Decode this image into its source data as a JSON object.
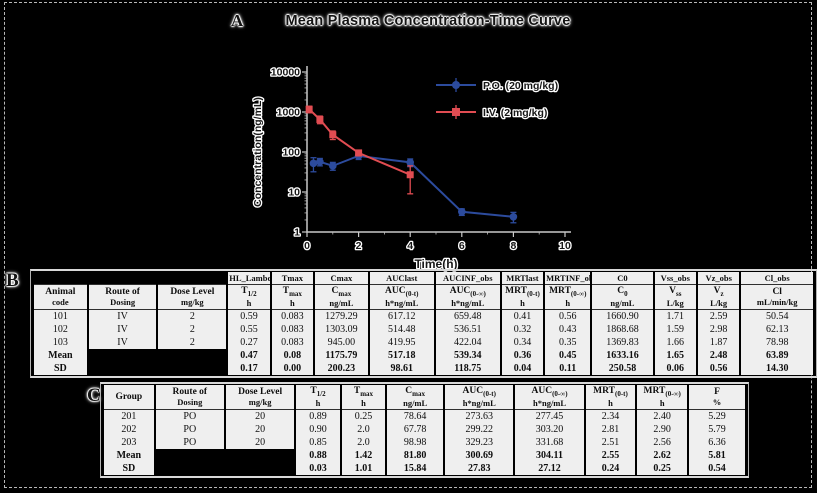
{
  "panel_a": {
    "label": "A",
    "title": "Mean Plasma Concentration-Time Curve"
  },
  "chart_data": {
    "type": "line",
    "title": "Mean Plasma Concentration-Time Curve",
    "xlabel": "Time(h)",
    "ylabel": "Concentration(ng/mL)",
    "xlim": [
      0,
      10
    ],
    "ylim": [
      1,
      10000
    ],
    "yscale": "log",
    "x_ticks": [
      0,
      2,
      4,
      6,
      8,
      10
    ],
    "y_ticks": [
      1,
      10,
      100,
      1000,
      10000
    ],
    "grid": false,
    "legend_position": "upper right",
    "series": [
      {
        "name": "P.O. (20 mg/kg)",
        "color": "#2c4b9d",
        "marker": "circle",
        "x": [
          0.25,
          0.5,
          1,
          2,
          4,
          6,
          8
        ],
        "y": [
          52,
          57,
          45,
          80,
          55,
          3.2,
          2.4
        ],
        "yerr": [
          20,
          12,
          10,
          15,
          12,
          0.6,
          0.7
        ]
      },
      {
        "name": "I.V. (2 mg/kg)",
        "color": "#e14c52",
        "marker": "square",
        "x": [
          0.083,
          0.5,
          1,
          2,
          4
        ],
        "y": [
          1175,
          650,
          270,
          95,
          27
        ],
        "yerr": [
          220,
          140,
          65,
          15,
          18
        ]
      }
    ]
  },
  "panel_b": {
    "label": "B",
    "table": {
      "code_row": [
        "",
        "",
        "",
        "HL_Lambda",
        "Tmax",
        "Cmax",
        "AUClast",
        "AUCINF_obs",
        "MRTlast",
        "MRTINF_obs",
        "C0",
        "Vss_obs",
        "Vz_obs",
        "Cl_obs"
      ],
      "headers": [
        {
          "main": "Animal",
          "line2": "code"
        },
        {
          "main": "Route of",
          "line2": "Dosing"
        },
        {
          "main": "Dose Level",
          "unit": "mg/kg"
        },
        {
          "main": "T",
          "sub": "1/2",
          "unit": "h"
        },
        {
          "main": "T",
          "sub": "max",
          "unit": "h"
        },
        {
          "main": "C",
          "sub": "max",
          "unit": "ng/mL"
        },
        {
          "main": "AUC",
          "sub": "(0-t)",
          "unit": "h*ng/mL"
        },
        {
          "main": "AUC",
          "sub": "(0-∞)",
          "unit": "h*ng/mL"
        },
        {
          "main": "MRT",
          "sub": "(0-t)",
          "unit": "h"
        },
        {
          "main": "MRT",
          "sub": "(0-∞)",
          "unit": "h"
        },
        {
          "main": "C",
          "sub": "0",
          "unit": "ng/mL"
        },
        {
          "main": "V",
          "sub": "ss",
          "unit": "L/kg"
        },
        {
          "main": "V",
          "sub": "z",
          "unit": "L/kg"
        },
        {
          "main": "Cl",
          "unit": "mL/min/kg"
        }
      ],
      "col_widths": [
        7,
        9,
        9,
        5.5,
        5.5,
        7,
        8.5,
        8.5,
        5.5,
        6,
        8,
        5.5,
        5.5,
        9.5
      ],
      "rows": [
        [
          "101",
          "IV",
          "2",
          "0.59",
          "0.083",
          "1279.29",
          "617.12",
          "659.48",
          "0.41",
          "0.56",
          "1660.90",
          "1.71",
          "2.59",
          "50.54"
        ],
        [
          "102",
          "IV",
          "2",
          "0.55",
          "0.083",
          "1303.09",
          "514.48",
          "536.51",
          "0.32",
          "0.43",
          "1868.68",
          "1.59",
          "2.98",
          "62.13"
        ],
        [
          "103",
          "IV",
          "2",
          "0.27",
          "0.083",
          "945.00",
          "419.95",
          "422.04",
          "0.34",
          "0.35",
          "1369.83",
          "1.66",
          "1.87",
          "78.98"
        ],
        [
          "Mean",
          "",
          "",
          "0.47",
          "0.08",
          "1175.79",
          "517.18",
          "539.34",
          "0.36",
          "0.45",
          "1633.16",
          "1.65",
          "2.48",
          "63.89"
        ],
        [
          "SD",
          "",
          "",
          "0.17",
          "0.00",
          "200.23",
          "98.61",
          "118.75",
          "0.04",
          "0.11",
          "250.58",
          "0.06",
          "0.56",
          "14.30"
        ]
      ]
    }
  },
  "panel_c": {
    "label": "C",
    "table": {
      "headers": [
        {
          "main": "Group"
        },
        {
          "main": "Route of",
          "line2": "Dosing"
        },
        {
          "main": "Dose Level",
          "unit": "mg/kg"
        },
        {
          "main": "T",
          "sub": "1/2",
          "unit": "h"
        },
        {
          "main": "T",
          "sub": "max",
          "unit": "h"
        },
        {
          "main": "C",
          "sub": "max",
          "unit": "ng/mL"
        },
        {
          "main": "AUC",
          "sub": "(0-t)",
          "unit": "h*ng/mL"
        },
        {
          "main": "AUC",
          "sub": "(0-∞)",
          "unit": "h*ng/mL"
        },
        {
          "main": "MRT",
          "sub": "(0-t)",
          "unit": "h"
        },
        {
          "main": "MRT",
          "sub": "(0-∞)",
          "unit": "h"
        },
        {
          "main": "F",
          "unit": "%"
        }
      ],
      "col_widths": [
        8,
        11,
        11,
        7,
        7,
        9,
        11,
        11,
        8,
        8,
        9
      ],
      "rows": [
        [
          "201",
          "PO",
          "20",
          "0.89",
          "0.25",
          "78.64",
          "273.63",
          "277.45",
          "2.34",
          "2.40",
          "5.29"
        ],
        [
          "202",
          "PO",
          "20",
          "0.90",
          "2.0",
          "67.78",
          "299.22",
          "303.20",
          "2.81",
          "2.90",
          "5.79"
        ],
        [
          "203",
          "PO",
          "20",
          "0.85",
          "2.0",
          "98.98",
          "329.23",
          "331.68",
          "2.51",
          "2.56",
          "6.36"
        ],
        [
          "Mean",
          "",
          "",
          "0.88",
          "1.42",
          "81.80",
          "300.69",
          "304.11",
          "2.55",
          "2.62",
          "5.81"
        ],
        [
          "SD",
          "",
          "",
          "0.03",
          "1.01",
          "15.84",
          "27.83",
          "27.12",
          "0.24",
          "0.25",
          "0.54"
        ]
      ]
    }
  }
}
